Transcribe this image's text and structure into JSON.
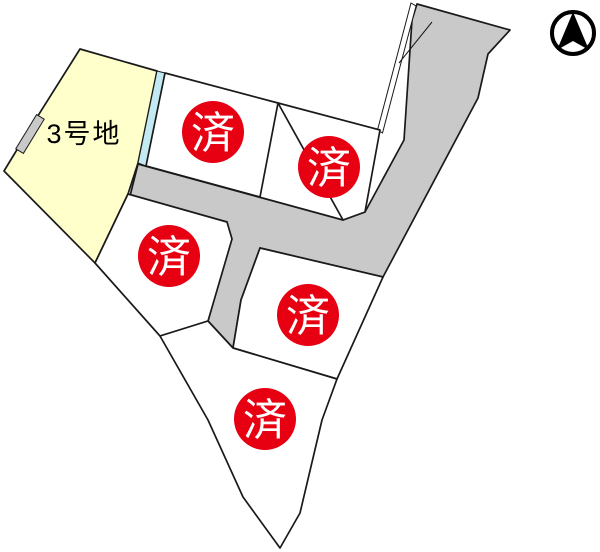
{
  "map": {
    "labels": {
      "lot3": "3号地",
      "sold": "済"
    },
    "colors": {
      "available_lot": "#ffffcc",
      "waterway_strip": "#c3e9f2",
      "road": "#c9c9c9",
      "parcel": "#ffffff",
      "background": "#ffffff",
      "sold_badge": "#e60012",
      "sold_text": "#ffffff",
      "outline": "#1a1a1a",
      "compass": "#000000"
    },
    "legend": {
      "sold_meaning": "済 = sold / contracted lot",
      "lot3_status": "available"
    }
  }
}
